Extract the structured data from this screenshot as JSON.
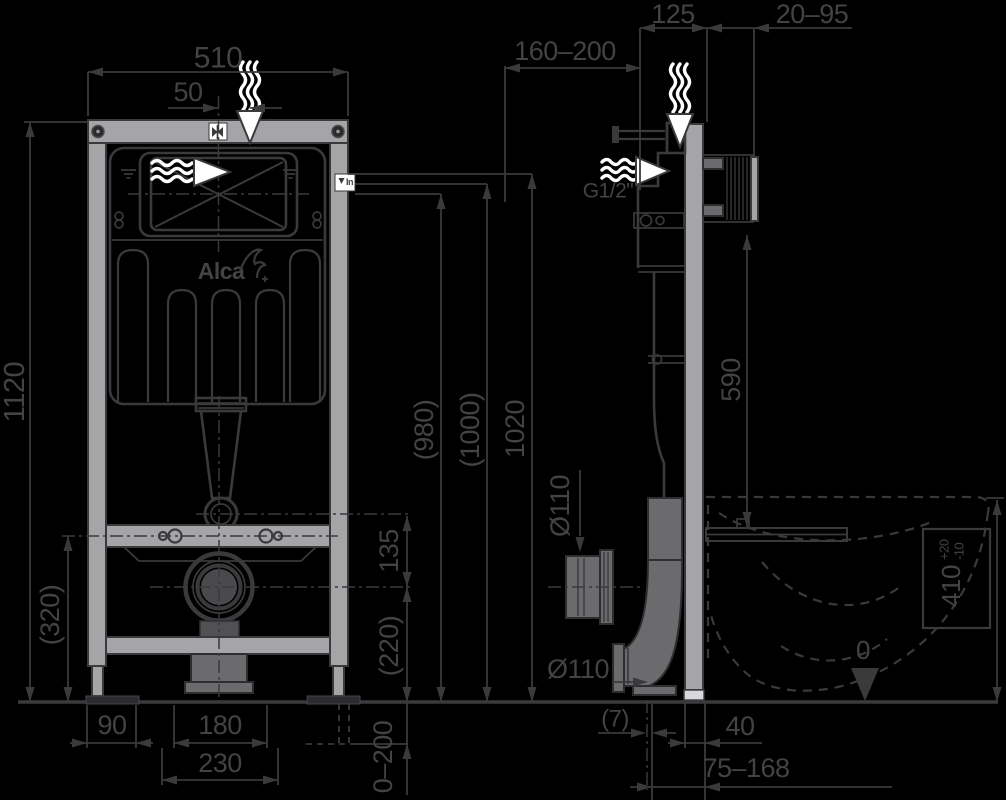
{
  "front": {
    "width": "510",
    "valve_offset": "50",
    "frame_height": "1120",
    "rail_height": "(320)",
    "foot_offset": "90",
    "bolt_spacing": "180",
    "pipe_spacing": "230",
    "flush_to_drain": "135",
    "drain_height": "(220)",
    "leg_adjust": "0–200",
    "inlet_h1": "(980)",
    "inlet_h2": "(1000)",
    "inlet_h3": "1020",
    "inlet_badge": "In",
    "brand": "Alca"
  },
  "side": {
    "frame_depth": "125",
    "wall_thickness": "20–95",
    "top_clearance": "160–200",
    "water_thread": "G1/2\"",
    "bracket_to_seat": "590",
    "sleeve_dia": "Ø110",
    "outlet_dia": "Ø110",
    "axis_gap": "(7)",
    "plate_gap": "40",
    "outlet_range": "75–168",
    "bowl_height": "410",
    "bowl_tol_plus": "+20",
    "bowl_tol_minus": "-10",
    "floor_datum": "0"
  }
}
